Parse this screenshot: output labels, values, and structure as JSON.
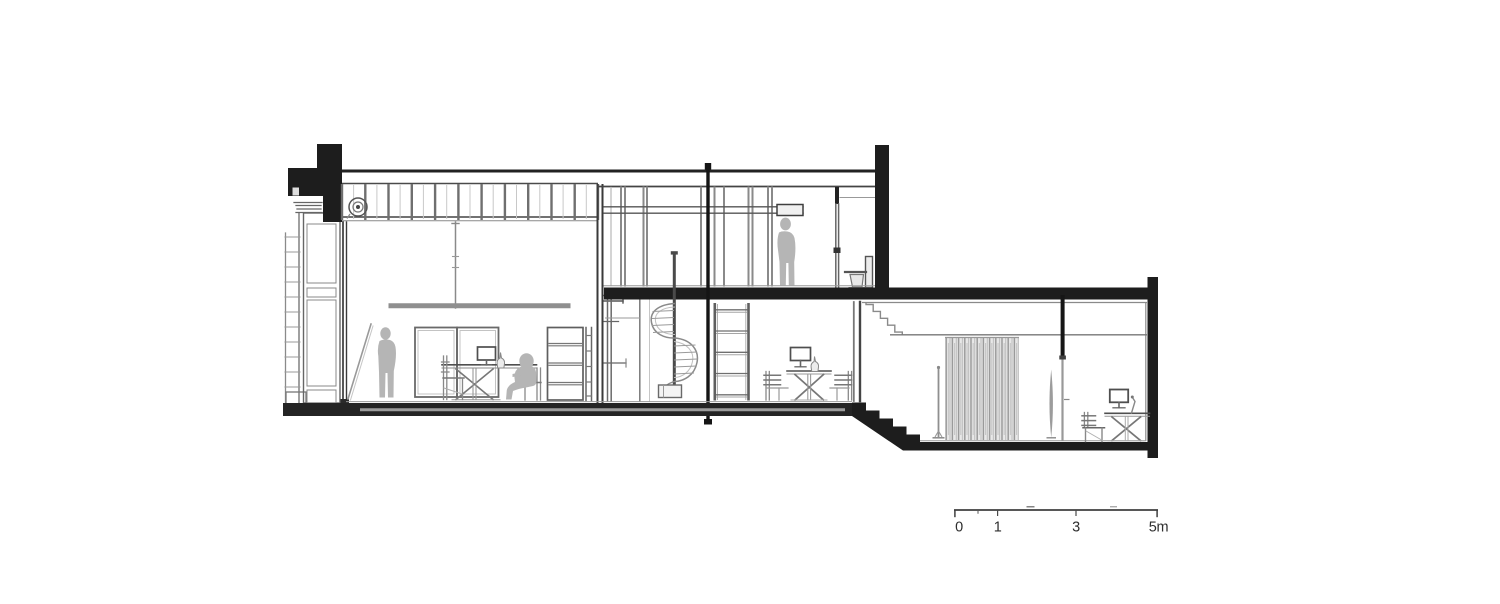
{
  "drawing": {
    "background": "#ffffff",
    "ink": {
      "poche": "#1d1d1d",
      "heavy": "#3a3a3a",
      "medium": "#6f6f6f",
      "light": "#9a9a9a",
      "faint": "#c4c4c4",
      "figure": "#b5b5b5"
    }
  },
  "scale_bar": {
    "labels": [
      "0",
      "1",
      "3",
      "5m"
    ],
    "text_color": "#2e2e2e"
  }
}
